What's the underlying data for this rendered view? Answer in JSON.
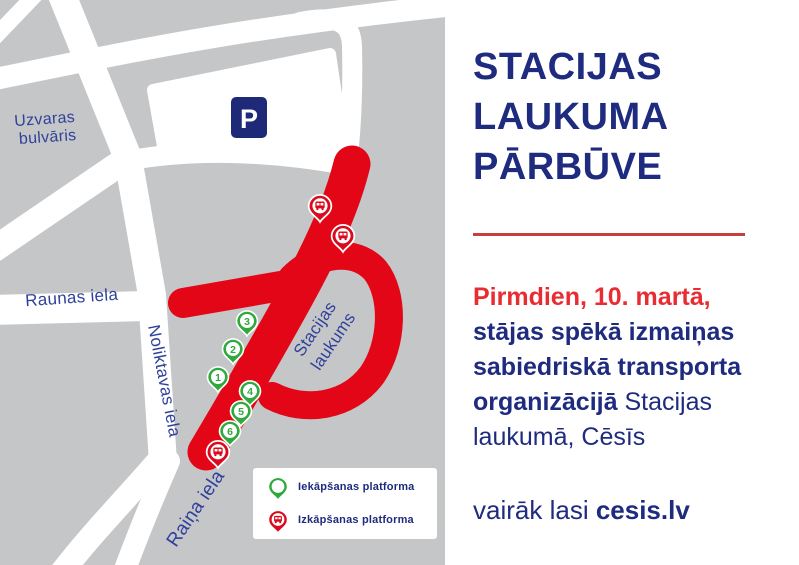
{
  "colors": {
    "map_gray": "#c5c6c8",
    "road_white": "#ffffff",
    "route_red": "#e30617",
    "pin_red": "#da0a1c",
    "pin_green": "#2fa83c",
    "navy": "#1e2b7e",
    "street_label_blue": "#30419b",
    "parking_navy": "#1e2a78",
    "divider_red": "#c8403c",
    "headline_red": "#e82c31"
  },
  "map": {
    "streets": {
      "uzvaras_line1": "Uzvaras",
      "uzvaras_line2": "bulvāris",
      "raunas": "Raunas iela",
      "noliktavas": "Noliktavas iela",
      "raina": "Raiņa iela",
      "stacijas_line1": "Stacijas",
      "stacijas_line2": "laukums"
    },
    "parking": {
      "label": "P"
    },
    "boarding_pins": [
      {
        "label": "1",
        "transform": "translate(218,392)"
      },
      {
        "label": "2",
        "transform": "translate(233,364)"
      },
      {
        "label": "3",
        "transform": "translate(247,336)"
      },
      {
        "label": "4",
        "transform": "translate(250,406)"
      },
      {
        "label": "5",
        "transform": "translate(241,426)"
      },
      {
        "label": "6",
        "transform": "translate(230,446)"
      }
    ],
    "dropoff_pins": [
      {
        "transform": "translate(320,222) scale(1.08)"
      },
      {
        "transform": "translate(343,252) scale(1.08)"
      },
      {
        "transform": "translate(218,468) scale(1.08)"
      }
    ]
  },
  "legend": {
    "items": [
      {
        "label": "Iekāpšanas platforma"
      },
      {
        "label": "Izkāpšanas platforma"
      }
    ]
  },
  "panel": {
    "title_line1": "STACIJAS",
    "title_line2": "LAUKUMA",
    "title_line3": "PĀRBŪVE",
    "date_line": "Pirmdien, 10. martā,",
    "bold_line1": "stājas spēkā izmaiņas",
    "bold_line2": "sabiedriskā transporta",
    "bold_word": "organizācijā",
    "regular_tail": " Stacijas",
    "regular_line": "laukumā, Cēsīs",
    "footer_regular": "vairāk lasi ",
    "footer_bold": "cesis.lv"
  }
}
